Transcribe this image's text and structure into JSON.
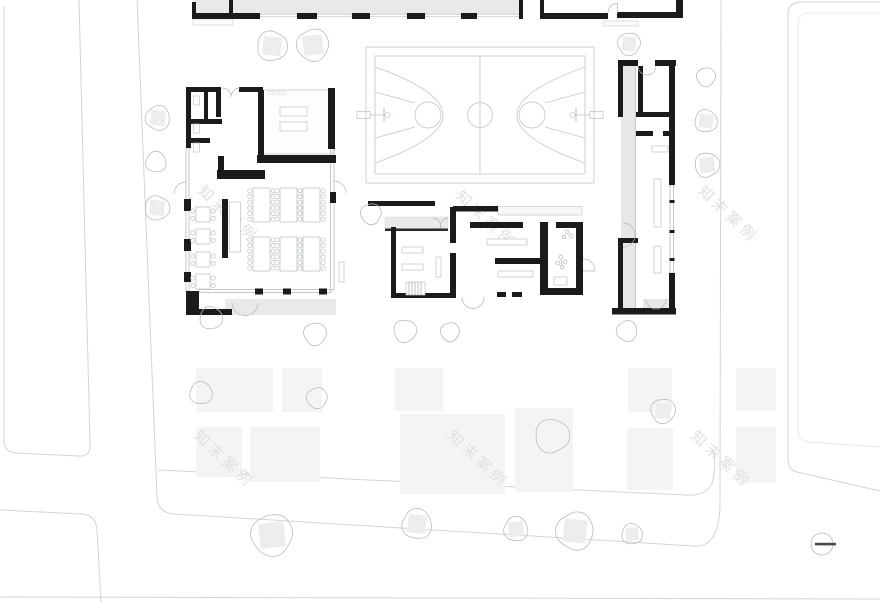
{
  "drawing": {
    "type": "architectural-site-plan",
    "subject": "school campus ground floor site plan with basketball court, dining hall, classroom buildings and landscaped courtyard"
  },
  "watermark": {
    "text": "知末案例",
    "color": "#e0e0e0",
    "rotation_deg": 43,
    "font_size": 15,
    "positions": [
      {
        "x": 197,
        "y": 192
      },
      {
        "x": 455,
        "y": 197
      },
      {
        "x": 697,
        "y": 192
      },
      {
        "x": 193,
        "y": 437
      },
      {
        "x": 447,
        "y": 437
      },
      {
        "x": 690,
        "y": 437
      }
    ]
  },
  "palette": {
    "background": "#ffffff",
    "wall": "#1b1b1b",
    "road_line": "#d4d4d4",
    "court_line": "#c7ccce",
    "furniture_line": "#bfc3c5",
    "canopy_fill": "#e9e9e9",
    "paving_fill": "#f4f4f4",
    "tree_line": "#b9bcbe",
    "tree_square_fill": "#ededee",
    "marker_dash": "#4a4a4a"
  },
  "site": {
    "trees": [
      {
        "x": 272,
        "y": 46,
        "r": 16,
        "sq": 1
      },
      {
        "x": 313,
        "y": 45,
        "r": 17,
        "sq": 1
      },
      {
        "x": 629,
        "y": 44,
        "r": 12,
        "sq": 1
      },
      {
        "x": 706,
        "y": 77,
        "r": 10,
        "sq": 0
      },
      {
        "x": 706,
        "y": 121,
        "r": 12,
        "sq": 1
      },
      {
        "x": 707,
        "y": 165,
        "r": 13,
        "sq": 1
      },
      {
        "x": 158,
        "y": 118,
        "r": 13,
        "sq": 1
      },
      {
        "x": 156,
        "y": 162,
        "r": 11,
        "sq": 0
      },
      {
        "x": 157,
        "y": 208,
        "r": 13,
        "sq": 1
      },
      {
        "x": 371,
        "y": 214,
        "r": 11,
        "sq": 0
      },
      {
        "x": 211,
        "y": 318,
        "r": 12,
        "sq": 0
      },
      {
        "x": 315,
        "y": 334,
        "r": 12,
        "sq": 0
      },
      {
        "x": 405,
        "y": 331,
        "r": 12,
        "sq": 0
      },
      {
        "x": 450,
        "y": 332,
        "r": 10,
        "sq": 0
      },
      {
        "x": 627,
        "y": 331,
        "r": 11,
        "sq": 0
      },
      {
        "x": 201,
        "y": 393,
        "r": 12,
        "sq": 0
      },
      {
        "x": 317,
        "y": 398,
        "r": 11,
        "sq": 0
      },
      {
        "x": 552,
        "y": 436,
        "r": 18,
        "sq": 0
      },
      {
        "x": 663,
        "y": 411,
        "r": 13,
        "sq": 1
      },
      {
        "x": 272,
        "y": 535,
        "r": 22,
        "sq": 1
      },
      {
        "x": 417,
        "y": 524,
        "r": 16,
        "sq": 1
      },
      {
        "x": 516,
        "y": 529,
        "r": 13,
        "sq": 1
      },
      {
        "x": 575,
        "y": 531,
        "r": 20,
        "sq": 1
      },
      {
        "x": 632,
        "y": 534,
        "r": 11,
        "sq": 1
      }
    ],
    "paving": [
      {
        "x": 196,
        "y": 368,
        "w": 77,
        "h": 44
      },
      {
        "x": 282,
        "y": 368,
        "w": 40,
        "h": 44
      },
      {
        "x": 395,
        "y": 368,
        "w": 48,
        "h": 43
      },
      {
        "x": 628,
        "y": 368,
        "w": 44,
        "h": 44
      },
      {
        "x": 736,
        "y": 368,
        "w": 40,
        "h": 43
      },
      {
        "x": 196,
        "y": 427,
        "w": 46,
        "h": 50
      },
      {
        "x": 250,
        "y": 427,
        "w": 70,
        "h": 55
      },
      {
        "x": 400,
        "y": 414,
        "w": 105,
        "h": 80
      },
      {
        "x": 515,
        "y": 408,
        "w": 58,
        "h": 84
      },
      {
        "x": 627,
        "y": 428,
        "w": 46,
        "h": 62
      },
      {
        "x": 736,
        "y": 427,
        "w": 40,
        "h": 56
      }
    ]
  },
  "dining_hall": {
    "long_table_size": {
      "w": 17,
      "h": 34,
      "chairs_per_side": 6
    },
    "long_tables": [
      {
        "x": 253,
        "y": 188
      },
      {
        "x": 280,
        "y": 188
      },
      {
        "x": 303,
        "y": 188
      },
      {
        "x": 253,
        "y": 237
      },
      {
        "x": 280,
        "y": 237
      },
      {
        "x": 303,
        "y": 237
      }
    ],
    "square_table_size": {
      "w": 14,
      "h": 15,
      "chairs_per_side": 2
    },
    "square_tables": [
      {
        "x": 196,
        "y": 207
      },
      {
        "x": 196,
        "y": 229
      },
      {
        "x": 196,
        "y": 252
      },
      {
        "x": 196,
        "y": 274
      }
    ]
  },
  "symbols": {
    "survey_marker": {
      "x": 822,
      "y": 544,
      "r": 11
    }
  }
}
